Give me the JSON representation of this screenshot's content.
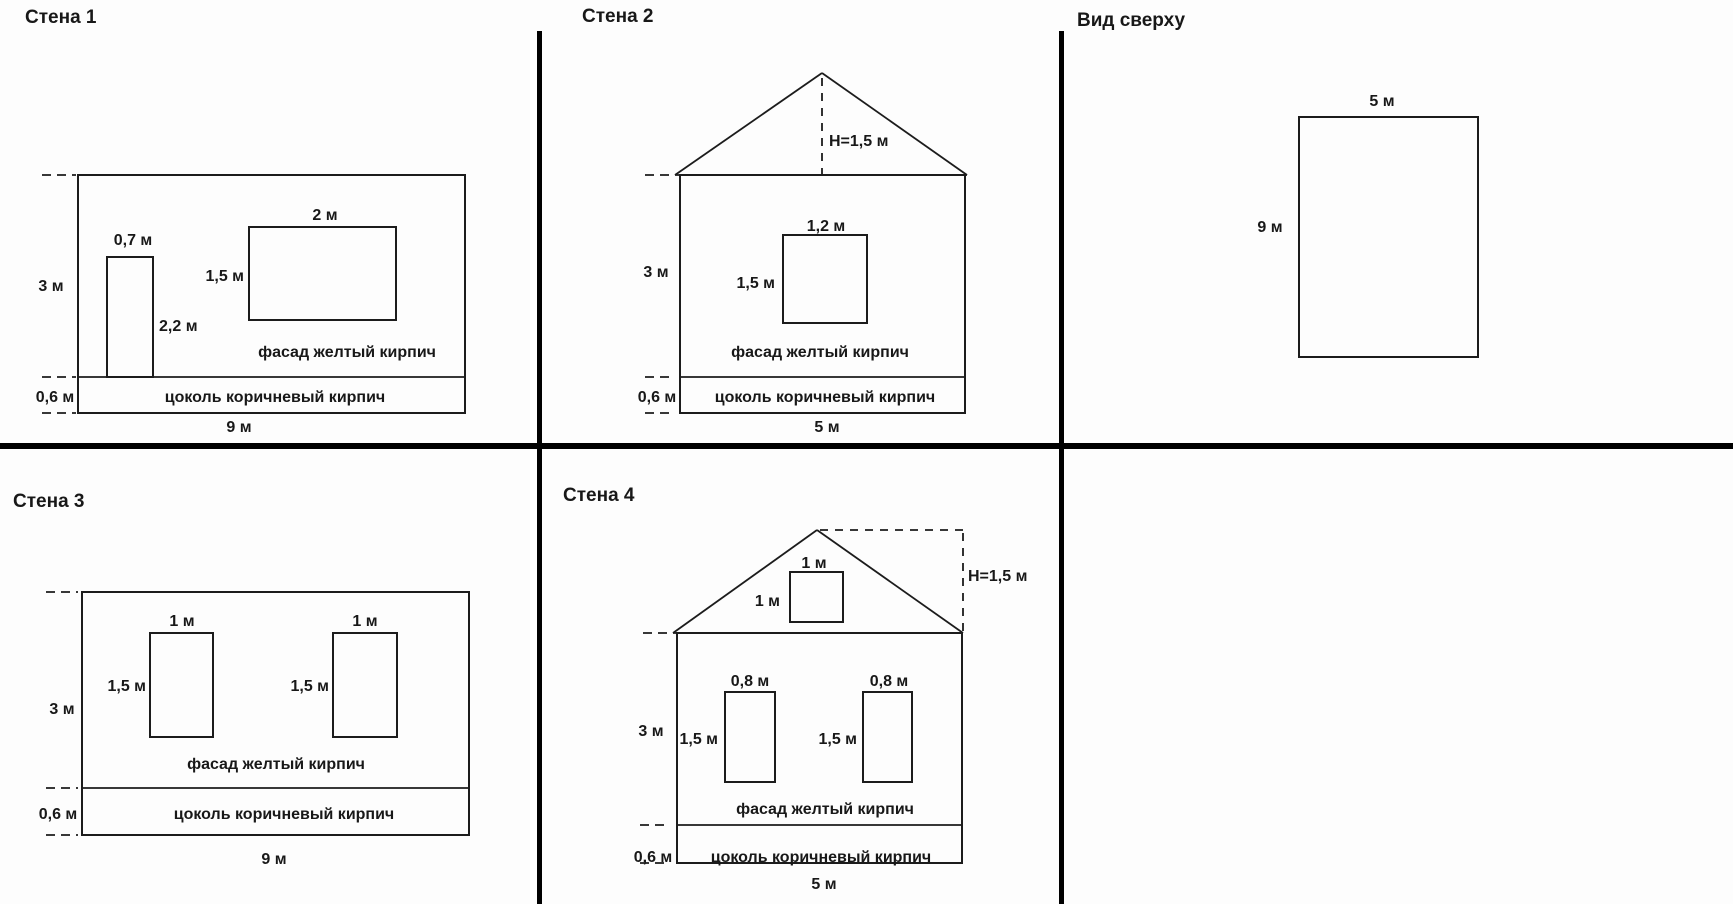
{
  "colors": {
    "background": "#fdfdfd",
    "line": "#1c1c1c",
    "divider": "#000000",
    "text": "#181818"
  },
  "wall1": {
    "title": "Стена 1",
    "door_width": "0,7 м",
    "door_height": "2,2 м",
    "window_width": "2 м",
    "window_height": "1,5 м",
    "wall_height": "3 м",
    "plinth_height": "0,6 м",
    "bottom_width": "9 м",
    "facade_label": "фасад желтый кирпич",
    "plinth_label": "цоколь коричневый кирпич"
  },
  "wall2": {
    "title": "Стена 2",
    "roof_height": "H=1,5 м",
    "window_width": "1,2 м",
    "window_height": "1,5 м",
    "wall_height": "3 м",
    "plinth_height": "0,6 м",
    "bottom_width": "5 м",
    "facade_label": "фасад желтый кирпич",
    "plinth_label": "цоколь коричневый кирпич"
  },
  "top_view": {
    "title": "Вид сверху",
    "width": "5 м",
    "depth": "9 м"
  },
  "wall3": {
    "title": "Стена 3",
    "window1_width": "1 м",
    "window1_height": "1,5 м",
    "window2_width": "1 м",
    "window2_height": "1,5 м",
    "wall_height": "3 м",
    "plinth_height": "0,6 м",
    "bottom_width": "9 м",
    "facade_label": "фасад желтый кирпич",
    "plinth_label": "цоколь коричневый кирпич"
  },
  "wall4": {
    "title": "Стена 4",
    "roof_height": "H=1,5 м",
    "attic_window_width": "1 м",
    "attic_window_height": "1 м",
    "window1_width": "0,8 м",
    "window1_height": "1,5 м",
    "window2_width": "0,8 м",
    "window2_height": "1,5 м",
    "wall_height": "3 м",
    "plinth_height": "0,6 м",
    "bottom_width": "5 м",
    "facade_label": "фасад желтый кирпич",
    "plinth_label": "цоколь коричневый кирпич"
  }
}
